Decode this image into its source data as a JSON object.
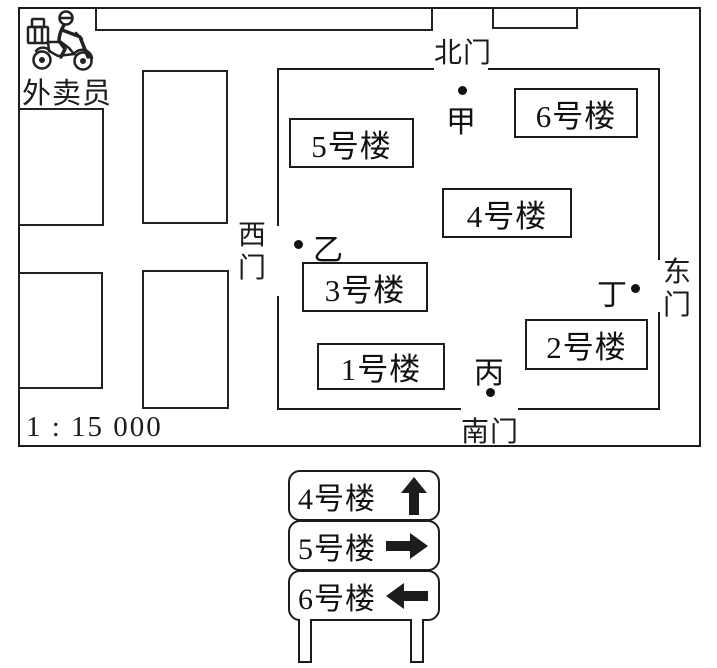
{
  "map": {
    "courier_label": "外卖员",
    "scale_label": "1 : 15 000",
    "gates": {
      "north": "北门",
      "south": "南门",
      "west": "西门",
      "east": "东门"
    },
    "buildings": [
      {
        "label": "1号楼"
      },
      {
        "label": "2号楼"
      },
      {
        "label": "3号楼"
      },
      {
        "label": "4号楼"
      },
      {
        "label": "5号楼"
      },
      {
        "label": "6号楼"
      }
    ],
    "points": [
      {
        "label": "甲"
      },
      {
        "label": "乙"
      },
      {
        "label": "丙"
      },
      {
        "label": "丁"
      }
    ]
  },
  "signpost": {
    "rows": [
      {
        "label": "4号楼",
        "direction": "up"
      },
      {
        "label": "5号楼",
        "direction": "right"
      },
      {
        "label": "6号楼",
        "direction": "left"
      }
    ]
  },
  "colors": {
    "ink": "#1c1c1c",
    "background": "#ffffff"
  }
}
